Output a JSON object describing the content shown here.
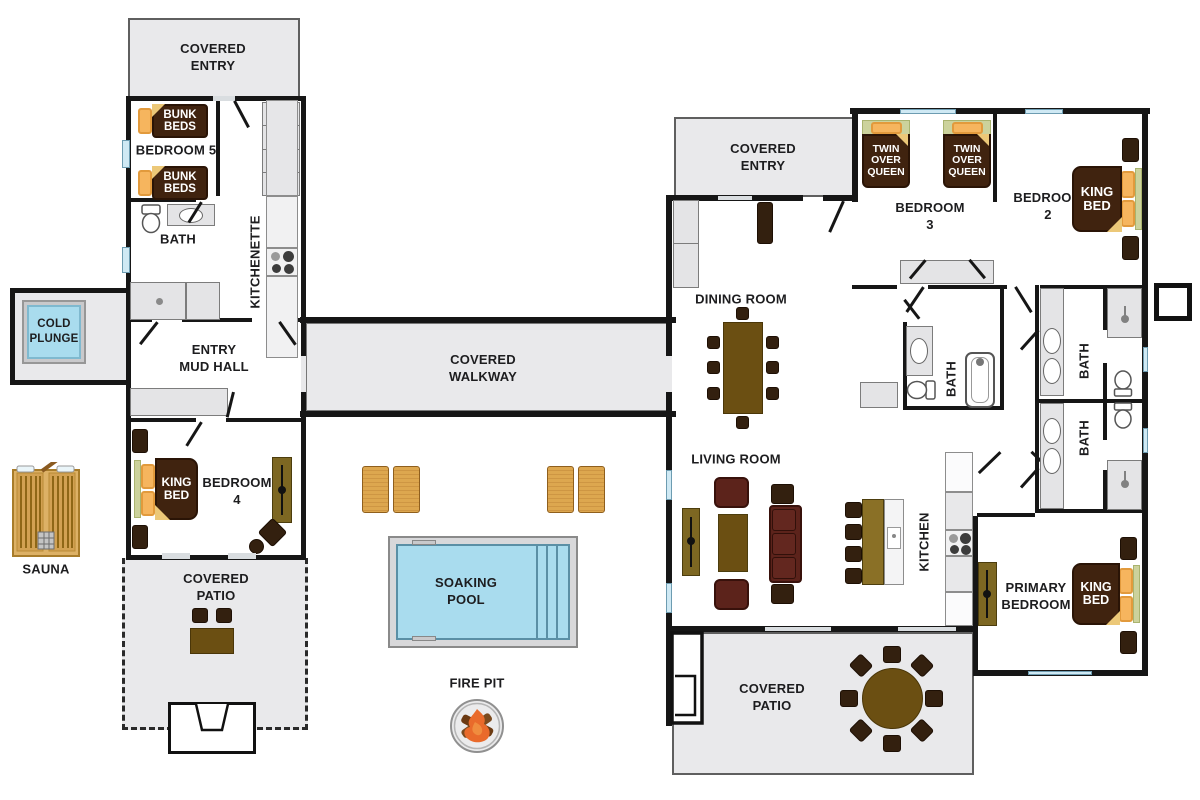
{
  "colors": {
    "wall": "#161616",
    "area_gray": "#e9e9eb",
    "water_blue": "#a9dcee",
    "bed_brown": "#40230f",
    "pillow_orange": "#f6b55e",
    "headboard_green": "#ccd29c",
    "fold_tan": "#ecc878",
    "table_brown": "#6b4f12",
    "seat_red": "#5c231b",
    "sauna_wood": "#ddb166",
    "fire_orange": "#e96a2b"
  },
  "guest_house": {
    "covered_entry": "COVERED\nENTRY",
    "bedroom5": "BEDROOM 5",
    "bunk_bed_1": "BUNK\nBEDS",
    "bunk_bed_2": "BUNK\nBEDS",
    "bath": "BATH",
    "kitchenette": "KITCHENETTE",
    "entry_mud_hall": "ENTRY\nMUD HALL",
    "bedroom4": "BEDROOM\n4",
    "bedroom4_bed": "KING\nBED",
    "covered_patio": "COVERED\nPATIO"
  },
  "grounds": {
    "cold_plunge": "COLD\nPLUNGE",
    "sauna": "SAUNA",
    "covered_walkway": "COVERED\nWALKWAY",
    "soaking_pool": "SOAKING\nPOOL",
    "fire_pit": "FIRE PIT"
  },
  "main_house": {
    "covered_entry": "COVERED\nENTRY",
    "dining_room": "DINING ROOM",
    "living_room": "LIVING ROOM",
    "kitchen": "KITCHEN",
    "bedroom3": "BEDROOM\n3",
    "bedroom3_bunk_1": "TWIN\nOVER\nQUEEN",
    "bedroom3_bunk_2": "TWIN\nOVER\nQUEEN",
    "bedroom2": "BEDROOM\n2",
    "bedroom2_bed": "KING\nBED",
    "bath_hall": "BATH",
    "bath_upper": "BATH",
    "bath_lower": "BATH",
    "primary_bedroom": "PRIMARY\nBEDROOM",
    "primary_bed": "KING\nBED",
    "covered_patio": "COVERED\nPATIO"
  }
}
